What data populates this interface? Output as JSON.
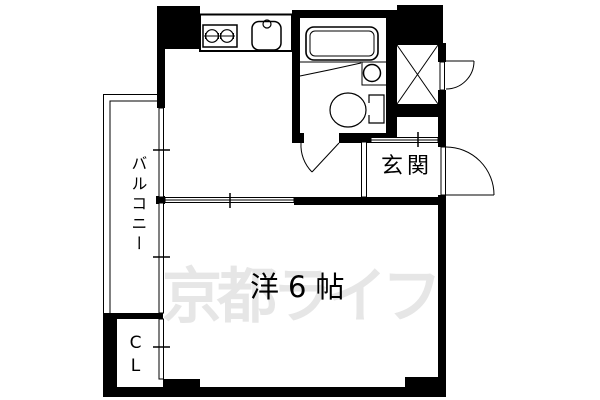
{
  "plan": {
    "watermark_text": "京都ライフ",
    "labels": {
      "main_room": "洋6帖",
      "entrance": "玄関",
      "balcony": "バルコニー",
      "closet": "CL"
    },
    "colors": {
      "line": "#000000",
      "background": "#ffffff",
      "watermark": "#e6e6e6"
    },
    "fixtures": {
      "kitchen": [
        "stove-icon",
        "sink-icon"
      ],
      "bathroom": [
        "bathtub-icon",
        "washbasin-icon",
        "toilet-icon"
      ],
      "building": [
        "elevator-shaft-icon"
      ]
    }
  }
}
